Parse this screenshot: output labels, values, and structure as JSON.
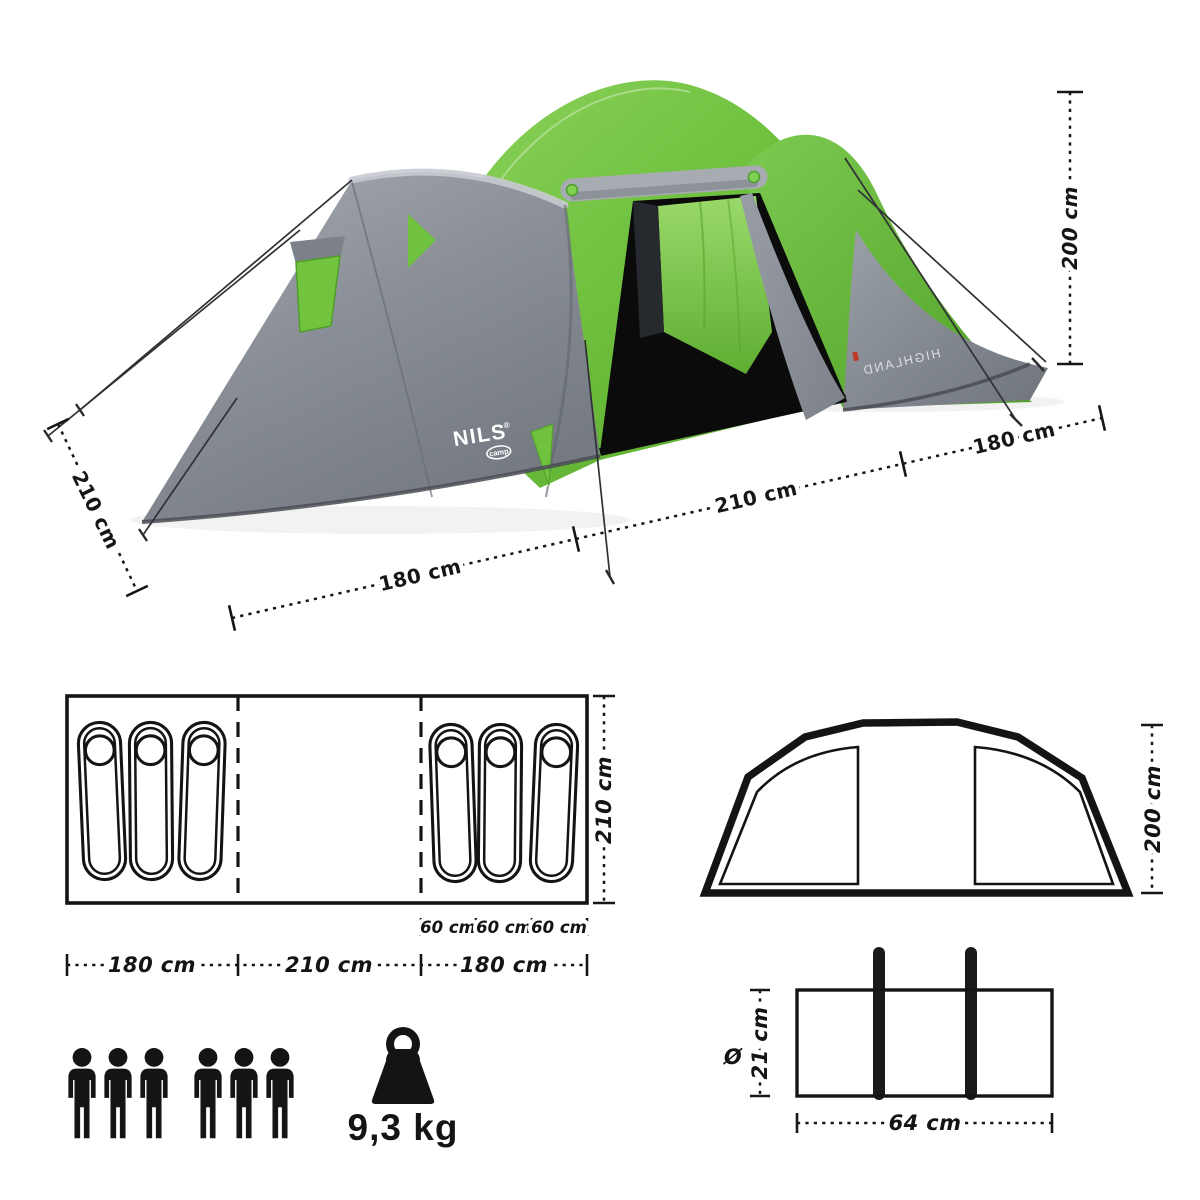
{
  "brand": {
    "name": "NILS",
    "registered": "®",
    "sub": "camp",
    "model_print": "HIGHLAND"
  },
  "photo": {
    "dim_depth_left": "210 cm",
    "dim_width_left": "180 cm",
    "dim_width_middle": "210 cm",
    "dim_width_right": "180 cm",
    "dim_height": "200 cm"
  },
  "floor_plan": {
    "dim_depth": "210 cm",
    "dim_sections": [
      "180 cm",
      "210 cm",
      "180 cm"
    ],
    "dim_beds": [
      "60 cm",
      "60 cm",
      "60 cm"
    ],
    "sleeping_bags_left": 3,
    "sleeping_bags_right": 3
  },
  "elevation": {
    "dim_height": "200 cm"
  },
  "capacity": {
    "persons": 6
  },
  "weight": {
    "value": "9,3 kg"
  },
  "carry_bag": {
    "diameter_symbol": "Ø",
    "dim_diameter": "21 cm",
    "dim_length": "64 cm"
  },
  "colors": {
    "tent_green": "#6fc13e",
    "tent_green_dark": "#4f9e2b",
    "tent_gray": "#8a8e95",
    "diagram_line": "#141414"
  }
}
